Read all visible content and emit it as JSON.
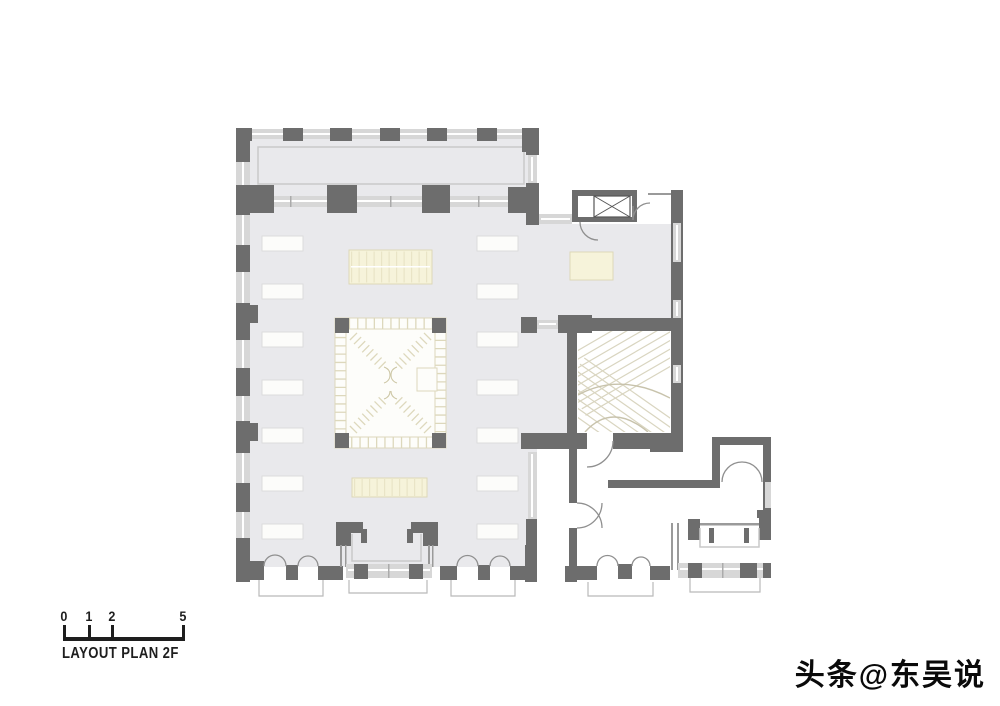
{
  "plan": {
    "kind": "architectural-floor-plan",
    "floor": "2F",
    "features": [
      "exhibition-hall",
      "gallery-colonnade",
      "central-void-stair",
      "elevator",
      "grand-stair-room",
      "annex-rooms",
      "bay-windows",
      "entry-doors"
    ]
  },
  "scale_bar": {
    "labels": [
      "0",
      "1",
      "2",
      "5"
    ],
    "title": "LAYOUT PLAN 2F"
  },
  "watermark": {
    "text": "头条@东吴说"
  },
  "colors": {
    "wall": "#6d6d6d",
    "floor": "#e9e9ec",
    "win": "#d7d7d7",
    "furn-fill": "#fcfcfa",
    "furn-stroke": "#dcdcdc",
    "cream-fill": "#f6f3da",
    "cream-stroke": "#ddd8b8",
    "cream-tick": "#e9e4c6",
    "stair": "#d9d5c0",
    "door": "#8f8f8f",
    "step": "#b9b9b9",
    "void-grid": "#ddd8bc",
    "ink": "#1e1e1e"
  }
}
